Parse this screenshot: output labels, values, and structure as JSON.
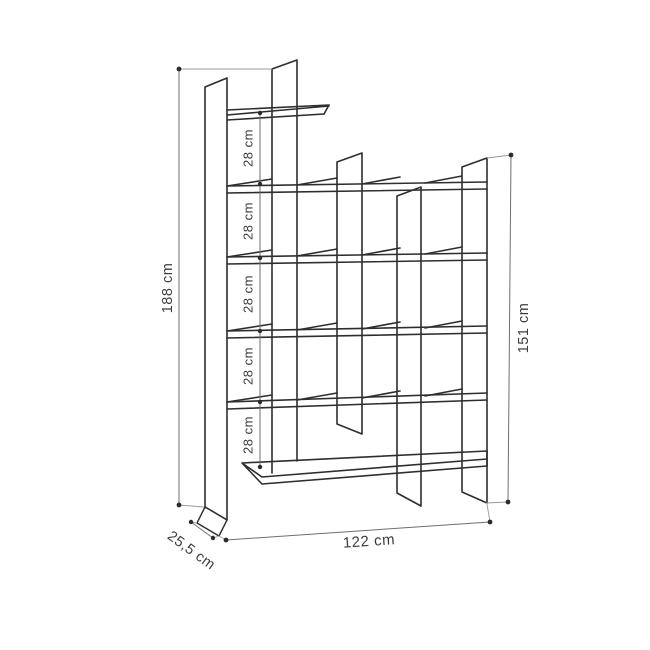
{
  "diagram": {
    "type": "furniture-dimension-drawing",
    "subject": "staggered bookshelf line drawing with dimension annotations",
    "background": "#ffffff",
    "line_color": "#2e2e2e",
    "dim_line_color": "#6e6e6e",
    "text_color": "#3d3d3d",
    "labels": {
      "total_height": "188 cm",
      "right_section_height": "151 cm",
      "total_width": "122 cm",
      "depth": "25,5 cm",
      "shelf_gaps": [
        "28 cm",
        "28 cm",
        "28 cm",
        "28 cm",
        "28 cm"
      ]
    }
  }
}
